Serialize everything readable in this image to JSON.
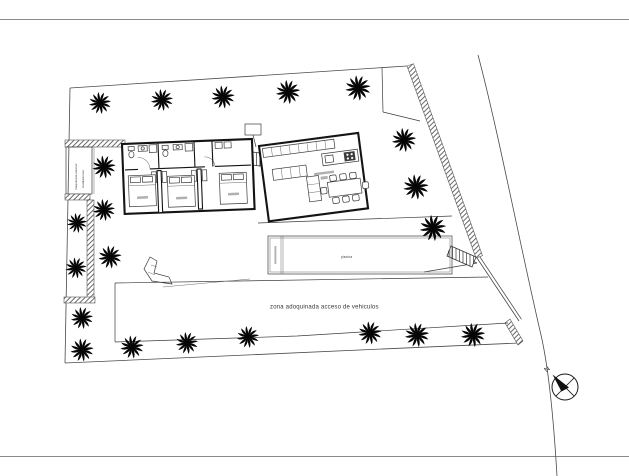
{
  "plan": {
    "colors": {
      "background": "#ffffff",
      "line": "#3c3c3c",
      "wall": "#141414",
      "palm": "#050505"
    },
    "labels": {
      "paved_zone": "zona adoquinada acceso de vehiculos",
      "pool": "piscina",
      "machinery_room_line1": "maquinaria exterior",
      "machinery_room_line2": "instalaciones",
      "north_indicator": "N"
    },
    "icons": {
      "palm": "palm-tree-icon",
      "north_arrow": "north-arrow-icon"
    },
    "palms": [
      [
        100,
        103,
        1.05
      ],
      [
        162,
        100,
        1.05
      ],
      [
        223,
        97,
        1.1
      ],
      [
        288,
        92,
        1.15
      ],
      [
        358,
        88,
        1.2
      ],
      [
        404,
        140,
        1.15
      ],
      [
        416,
        187,
        1.2
      ],
      [
        433,
        228,
        1.25
      ],
      [
        104,
        167,
        1.1
      ],
      [
        104,
        210,
        1.05
      ],
      [
        77,
        223,
        0.95
      ],
      [
        110,
        257,
        1.1
      ],
      [
        76,
        268,
        1.0
      ],
      [
        82,
        318,
        1.05
      ],
      [
        82,
        350,
        1.1
      ],
      [
        132,
        347,
        1.1
      ],
      [
        187,
        343,
        1.05
      ],
      [
        248,
        337,
        1.05
      ],
      [
        370,
        333,
        1.1
      ],
      [
        417,
        335,
        1.15
      ],
      [
        473,
        335,
        1.15
      ]
    ]
  }
}
